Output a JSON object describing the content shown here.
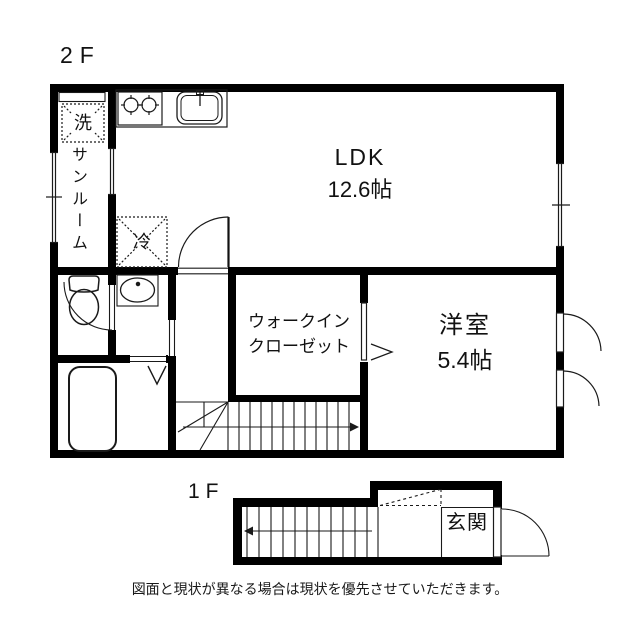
{
  "floor_labels": {
    "second": "2F",
    "first": "1F"
  },
  "rooms": {
    "ldk": {
      "name": "LDK",
      "size": "12.6帖"
    },
    "western_room": {
      "name": "洋室",
      "size": "5.4帖"
    },
    "walk_in_closet": {
      "line1": "ウォークイン",
      "line2": "クローゼット"
    },
    "sunroom": {
      "name": "サンルーム"
    },
    "entrance": {
      "name": "玄関"
    }
  },
  "fixtures": {
    "washer_label": "洗",
    "refrigerator_label": "冷"
  },
  "caption": "図面と現状が異なる場合は現状を優先させていただきます。",
  "colors": {
    "wall": "#000000",
    "line": "#1a1a1a",
    "background": "#ffffff"
  }
}
